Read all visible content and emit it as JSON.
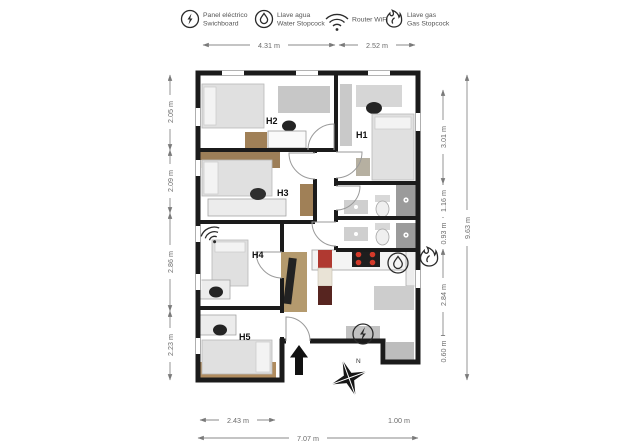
{
  "legend": {
    "items": [
      {
        "icon": "switchboard-icon",
        "line1": "Panel eléctrico",
        "line2": "Swichboard"
      },
      {
        "icon": "water-stopcock-icon",
        "line1": "Llave agua",
        "line2": "Water Stopcock"
      },
      {
        "icon": "wifi-icon",
        "line1": "Router WiFi",
        "line2": ""
      },
      {
        "icon": "gas-stopcock-icon",
        "line1": "Llave gas",
        "line2": "Gas Stopcock"
      }
    ]
  },
  "rooms": {
    "h1": {
      "label": "H1"
    },
    "h2": {
      "label": "H2"
    },
    "h3": {
      "label": "H3"
    },
    "h4": {
      "label": "H4"
    },
    "h5": {
      "label": "H5"
    }
  },
  "dimensions": {
    "top": [
      "4.31 m",
      "2.52 m"
    ],
    "left": [
      "2.05 m",
      "2.09 m",
      "2.86 m",
      "2.23 m"
    ],
    "right": [
      "3.01 m",
      "1.16 m",
      "0.93 m",
      "2.84 m",
      "0.60 m"
    ],
    "right_total": "9.63 m",
    "bottom": [
      "2.43 m",
      "1.00 m"
    ],
    "bottom_total": "7.07 m"
  },
  "compass": {
    "north": "N"
  },
  "plan_markers": {
    "wifi": "router-wifi-marker",
    "water": "water-stopcock-marker",
    "gas": "gas-stopcock-marker",
    "switchboard": "switchboard-marker",
    "entrance": "entrance-arrow-marker"
  },
  "colors": {
    "wall": "#1b1b1b",
    "wood": "#a08057",
    "stove_burner": "#d43a2a",
    "shelf_red": "#b03931",
    "shelf_maroon": "#572520",
    "dim_text": "#6b6b6b"
  }
}
